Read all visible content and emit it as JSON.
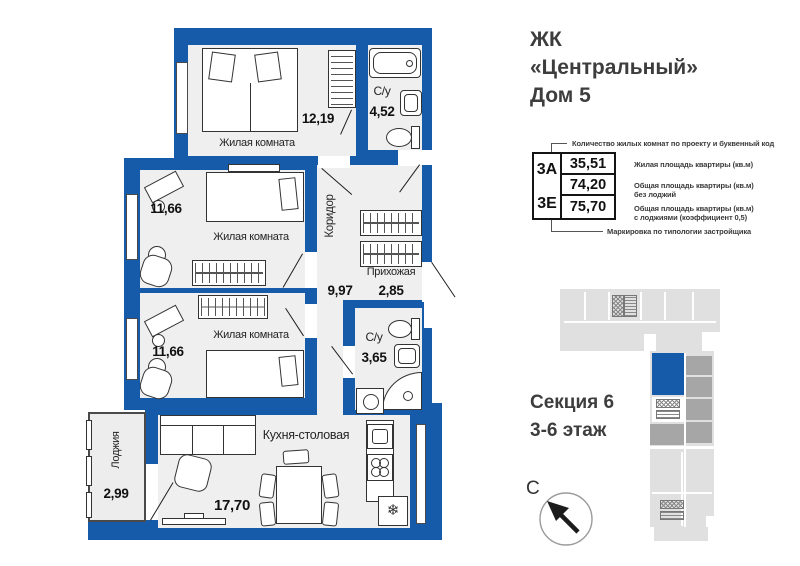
{
  "header": {
    "title_line1": "ЖК",
    "title_line2": "«Центральный»",
    "title_line3": "Дом 5"
  },
  "plan": {
    "rooms": [
      {
        "name": "Жилая комната",
        "area": "12,19"
      },
      {
        "name": "С/у",
        "area": "4,52"
      },
      {
        "name": "Жилая комната",
        "area": "11,66"
      },
      {
        "name": "Коридор",
        "area": "9,97"
      },
      {
        "name": "Прихожая",
        "area": "2,85"
      },
      {
        "name": "Жилая комната",
        "area": "11,66"
      },
      {
        "name": "С/у",
        "area": "3,65"
      },
      {
        "name": "Кухня-столовая",
        "area": "17,70"
      },
      {
        "name": "Лоджия",
        "area": "2,99"
      }
    ]
  },
  "spec": {
    "callout_top": "Количество жилых комнат по проекту и буквенный код",
    "type_code_top": "3А",
    "type_code_bottom": "3Е",
    "living_area": "35,51",
    "total_area": "74,20",
    "total_area_with_loggia": "75,70",
    "notes": [
      {
        "line1": "Жилая площадь квартиры (кв.м)",
        "line2": ""
      },
      {
        "line1": "Общая площадь квартиры (кв.м)",
        "line2": "без лоджий"
      },
      {
        "line1": "Общая площадь квартиры (кв.м)",
        "line2": "с лоджиями (коэффициент 0,5)"
      }
    ],
    "callout_bottom": "Маркировка по типологии застройщика"
  },
  "section": {
    "line1": "Секция 6",
    "line2": "3-6 этаж"
  },
  "compass": {
    "north_label": "С"
  },
  "colors": {
    "wall": "#165aaa",
    "floor": "#efefef",
    "mm-gray": "#a6a6a6",
    "mm-light": "#e0e0e0",
    "ink": "#3d3d3d"
  }
}
